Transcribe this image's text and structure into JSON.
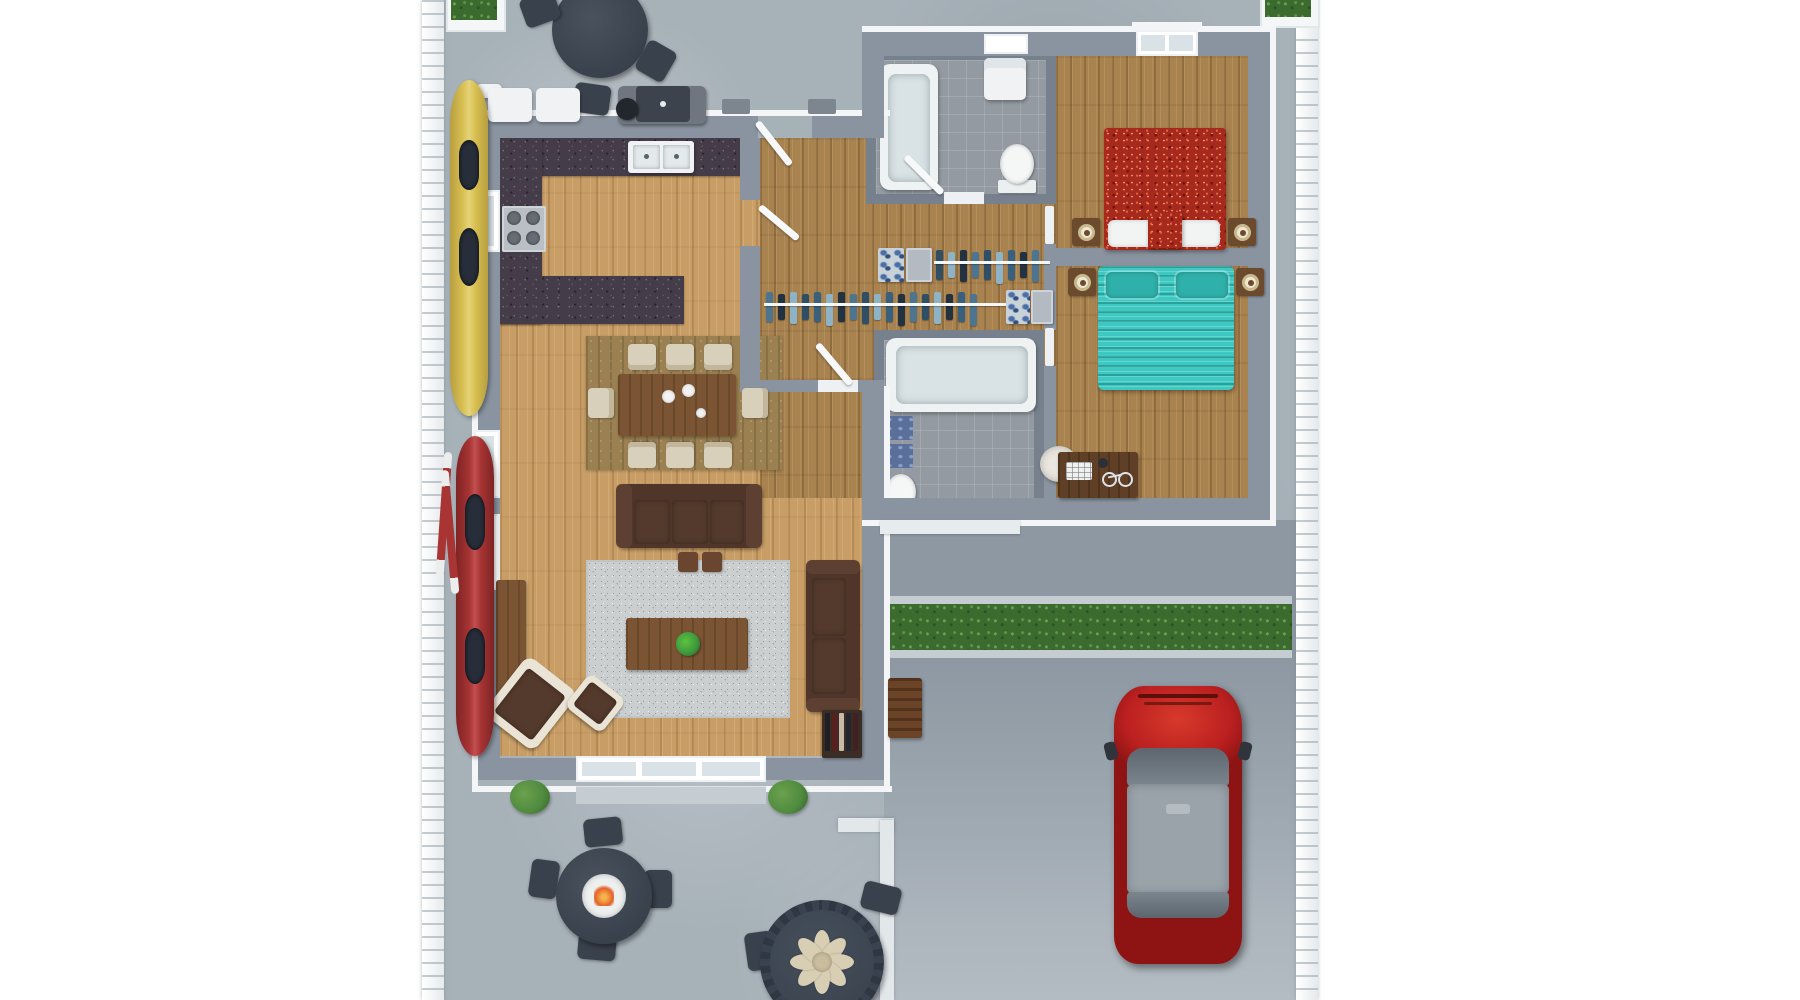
{
  "scene": {
    "kind": "3d-rendered-floor-plan",
    "view": "top-down",
    "description": "Single-story house rendering with open living/kitchen area, two bedrooms, two bathrooms, closet hallway, front porch with grill and dining set, side yard with kayaks, rear patio with fire table and flower table, hedge strip and driveway with parked red SUV"
  },
  "palette": {
    "concrete": "#a7b1b8",
    "concrete-dark": "#8d98a2",
    "wall": "#8a94a0",
    "trim": "#f3f5f6",
    "wood-living": "#c89e66",
    "wood-bedroom": "#a8824f",
    "tile": "#939aa1",
    "granite": "#453c49",
    "rug": "#cccfd0",
    "dining-rug": "#9b8152",
    "sofa": "#4f352a",
    "wood-furn": "#7a5433",
    "cream": "#d9d0bb",
    "nightstand": "#6b4a2e",
    "lamp": "#efe7d2",
    "red-bed": "#a5291c",
    "teal-bed": "#3ec8c2",
    "hedge": "#3c6b2f",
    "shrub": "#4f8a3e",
    "kayak-yellow": "#d9c153",
    "kayak-red": "#a83434",
    "car-red": "#bc2020",
    "car-roof": "#9aa3aa",
    "slate": "#39414d",
    "flower": "#d8ceb4"
  },
  "rooms": [
    {
      "name": "living-room",
      "floor": "light oak plank"
    },
    {
      "name": "kitchen",
      "floor": "light oak plank",
      "counters": "dark granite C-shape"
    },
    {
      "name": "dining-area",
      "floor": "light oak plank over woven rug"
    },
    {
      "name": "entry-hall-closets",
      "floor": "walnut plank"
    },
    {
      "name": "bathroom-1",
      "floor": "gray tile"
    },
    {
      "name": "bathroom-2",
      "floor": "gray tile"
    },
    {
      "name": "bedroom-1",
      "floor": "walnut plank",
      "bed": "red patterned queen"
    },
    {
      "name": "bedroom-2",
      "floor": "walnut plank",
      "bed": "teal ruffled queen"
    },
    {
      "name": "front-porch",
      "surface": "concrete"
    },
    {
      "name": "rear-patio",
      "surface": "concrete"
    },
    {
      "name": "driveway",
      "surface": "concrete"
    }
  ],
  "furniture": {
    "kitchen": [
      "granite counter with double sink",
      "gas stove 4 burners",
      "granite island"
    ],
    "dining": {
      "table": "rectangular walnut",
      "chairs": 8,
      "plates": 3
    },
    "living": [
      "3-seat sofa",
      "loveseat",
      "armchair with ottoman",
      "coffee table with plant",
      "console cabinet",
      "bookshelf",
      "2 footstools",
      "gray area rug"
    ],
    "bedroom1": [
      "red patterned bed",
      "2 pillows",
      "2 nightstands with lamps"
    ],
    "bedroom2": [
      "teal ruffled bed",
      "2 pillows",
      "2 nightstands with lamps",
      "desk with chair, notepad and bicycle trinket"
    ],
    "bathroom1": [
      "bathtub",
      "toilet",
      "linen shelf"
    ],
    "bathroom2": [
      "large soaking tub",
      "toilet",
      "2 blue mats"
    ],
    "burners": 4
  },
  "closets": {
    "row1": {
      "garments": [
        "#2e4f66",
        "#8fb3c6",
        "#223240",
        "#4d7590",
        "#2e4f66",
        "#8fb3c6",
        "#39607c",
        "#223240",
        "#4d7590"
      ],
      "bins": [
        "blue-pattern",
        "gray"
      ]
    },
    "row2": {
      "garments": [
        "#4d7590",
        "#223240",
        "#8fb3c6",
        "#2e4f66",
        "#39607c",
        "#8fb3c6",
        "#223240",
        "#4d7590",
        "#2e4f66",
        "#8fb3c6",
        "#39607c",
        "#223240",
        "#4d7590",
        "#2e4f66",
        "#8fb3c6",
        "#223240",
        "#39607c",
        "#4d7590"
      ],
      "bins": [
        "blue-pattern",
        "gray"
      ]
    }
  },
  "books": {
    "spines": [
      "#1f1f24",
      "#5a1f1f",
      "#c9b9a6",
      "#23262e",
      "#402020"
    ]
  },
  "exterior": {
    "front": [
      "round charcoal dining table with 3 chairs",
      "2 white cube stools",
      "barbecue grill",
      "corner planters"
    ],
    "side": [
      "yellow kayak",
      "red kayak",
      "2 red paddles",
      "white scalloped fence"
    ],
    "rear": [
      "fire-pit table with 4 chairs",
      "flower-centerpiece table with 2 chairs",
      "2 shrubs",
      "wood bench"
    ],
    "hedge_rows": 1,
    "flower_table": {
      "petal_count": 8
    },
    "car": {
      "type": "SUV",
      "body_color": "red",
      "roof_color": "gray"
    }
  }
}
